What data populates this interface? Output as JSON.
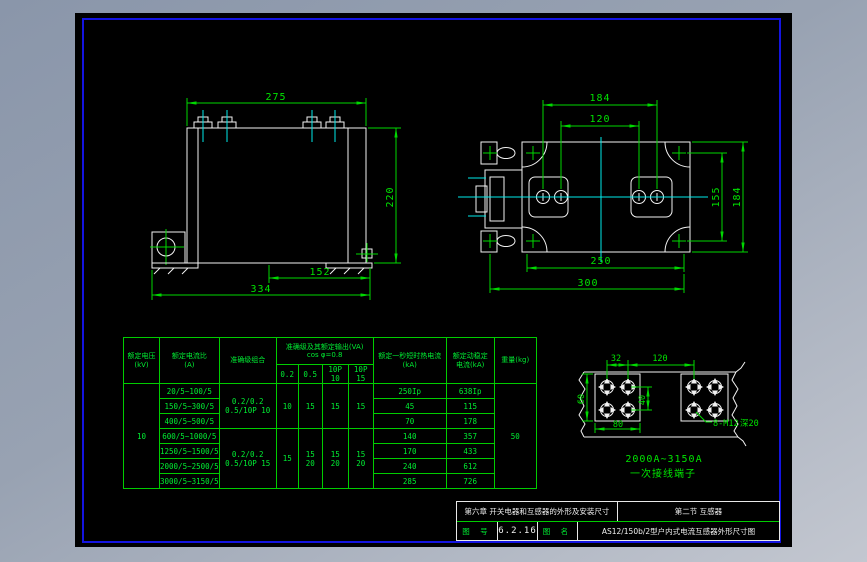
{
  "app": {
    "background_top": "#8a96aa",
    "background_bottom": "#c3c7d0",
    "canvas_color": "#000000",
    "frame_color": "#1414e0",
    "geometry_color": "#f2f2f2",
    "dimension_color": "#00d800",
    "centerline_color": "#00eaea"
  },
  "front_view": {
    "dim_width": "275",
    "dim_height": "220",
    "dim_foot": "152",
    "dim_total": "334"
  },
  "top_view": {
    "dim_hole_span": "184",
    "dim_hole_pitch": "120",
    "dim_side_inner": "155",
    "dim_side": "184",
    "dim_base": "250",
    "dim_total": "300"
  },
  "detail_view": {
    "dim_hole_col": "32",
    "dim_span": "120",
    "dim_height": "60",
    "dim_hole_row": "40",
    "dim_width": "80",
    "label_holes": "8-M12",
    "label_depth": "深20",
    "label_range": "2000A~3150A",
    "label_caption": "一次接线端子"
  },
  "table": {
    "col_voltage": "额定电压\n(kV)",
    "col_ratio": "额定电流比\n(A)",
    "col_combo": "准确级组合",
    "col_output": "准确级及其额定输出(VA)\ncos φ=0.8",
    "col_thermal": "额定一秒短时热电流\n(kA)",
    "col_dynamic": "额定动稳定\n电流(kA)",
    "col_weight": "重量(kg)",
    "sub": [
      "0.2",
      "0.5",
      "10P 10",
      "10P 15"
    ],
    "voltage": "10",
    "weight": "50",
    "combo1": "0.2/0.2\n0.5/10P 10",
    "combo2": "0.2/0.2\n0.5/10P 15",
    "out1": [
      "10",
      "15",
      "15",
      "15"
    ],
    "out2": [
      "15",
      "15\n20",
      "15\n20",
      "15\n20"
    ],
    "rows": [
      {
        "ratio": "20/5~100/5",
        "thermal": "250Ip",
        "dynamic": "638Ip"
      },
      {
        "ratio": "150/5~300/5",
        "thermal": "45",
        "dynamic": "115"
      },
      {
        "ratio": "400/5~500/5",
        "thermal": "70",
        "dynamic": "178"
      },
      {
        "ratio": "600/5~1000/5",
        "thermal": "140",
        "dynamic": "357"
      },
      {
        "ratio": "1250/5~1500/5",
        "thermal": "170",
        "dynamic": "433"
      },
      {
        "ratio": "2000/5~2500/5",
        "thermal": "240",
        "dynamic": "612"
      },
      {
        "ratio": "3000/5~3150/5",
        "thermal": "285",
        "dynamic": "726"
      }
    ]
  },
  "title_block": {
    "chapter": "第六章 开关电器和互感器的外形及安装尺寸",
    "section": "第二节 互感器",
    "fig_no_label": "图 号",
    "fig_no": "6.2.16",
    "fig_name_label": "图 名",
    "fig_name": "AS12/150b/2型户内式电流互感器外形尺寸图"
  }
}
